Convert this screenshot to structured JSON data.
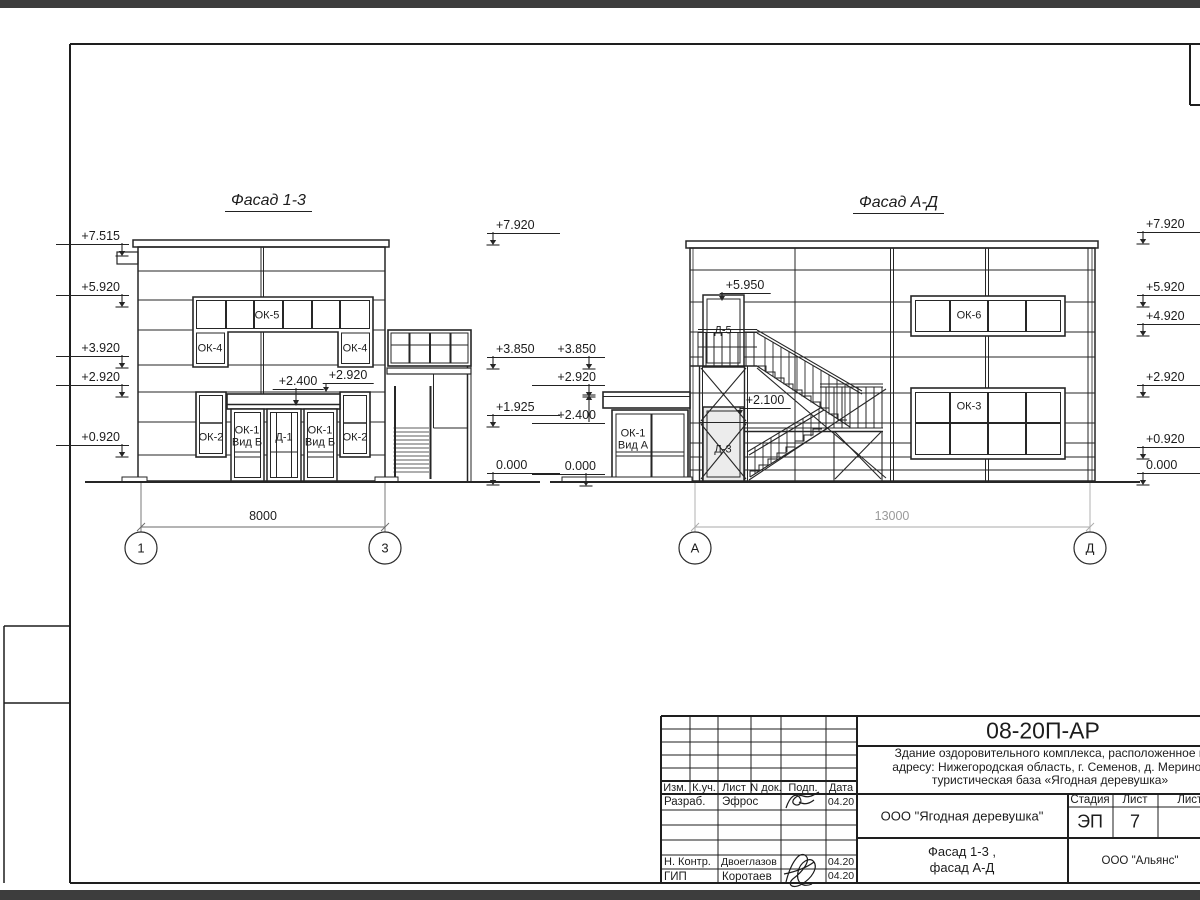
{
  "colors": {
    "paper": "#ffffff",
    "outside": "#3d3d3d",
    "line": "#262626",
    "gray_dim": "#9a9a9a"
  },
  "facade_13": {
    "title": "Фасад 1-3",
    "elev_left": [
      "+7.515",
      "+5.920",
      "+3.920",
      "+2.920",
      "+0.920"
    ],
    "elev_right": [
      "+7.920",
      "+3.850",
      "+1.925",
      "0.000"
    ],
    "callout_canopy": "+2.400",
    "callout_ok2": "+2.920",
    "labels": {
      "ok5": "ОК-5",
      "ok4": "ОК-4",
      "ok2": "ОК-2",
      "ok1": "ОК-1",
      "ok1_sub": "Вид Б",
      "d1": "Д-1"
    },
    "dimension": "8000",
    "axis_left": "1",
    "axis_right": "3"
  },
  "facade_ad": {
    "title": "Фасад А-Д",
    "elev_left": [
      "+3.850",
      "+2.920",
      "+2.400",
      "0.000"
    ],
    "elev_right": [
      "+7.920",
      "+5.920",
      "+4.920",
      "+2.920",
      "+0.920",
      "0.000"
    ],
    "callout_d5": "+5.950",
    "callout_d3": "+2.100",
    "labels": {
      "ok6": "ОК-6",
      "ok3": "ОК-3",
      "ok1": "ОК-1",
      "ok1_sub": "Вид А",
      "d5": "Д-5",
      "d3": "Д-3"
    },
    "dimension": "13000",
    "axis_left": "А",
    "axis_right": "Д"
  },
  "title_block": {
    "doc_number": "08-20П-АР",
    "description_line1": "Здание оздоровительного комплекса, расположенное п",
    "description_line2": "адресу: Нижегородская область, г. Семенов, д. Меринов",
    "description_line3": "туристическая база «Ягодная деревушка»",
    "header": {
      "izm": "Изм.",
      "kuch": "К.уч.",
      "list": "Лист",
      "ndok": "N док.",
      "podp": "Подп.",
      "data": "Дата"
    },
    "row_developer": {
      "role": "Разраб.",
      "name": "Эфрос",
      "date": "04.20"
    },
    "row_ncontrol": {
      "role": "Н. Контр.",
      "name": "Двоеглазов",
      "date": "04.20"
    },
    "row_gip": {
      "role": "ГИП",
      "name": "Коротаев",
      "date": "04.20"
    },
    "client": "ООО \"Ягодная деревушка\"",
    "stage_label": "Стадия",
    "sheet_label": "Лист",
    "sheets_label": "Листов",
    "stage": "ЭП",
    "sheet_number": "7",
    "sheet_title_line1": "Фасад 1-3 ,",
    "sheet_title_line2": "фасад А-Д",
    "company": "ООО \"Альянс\""
  }
}
